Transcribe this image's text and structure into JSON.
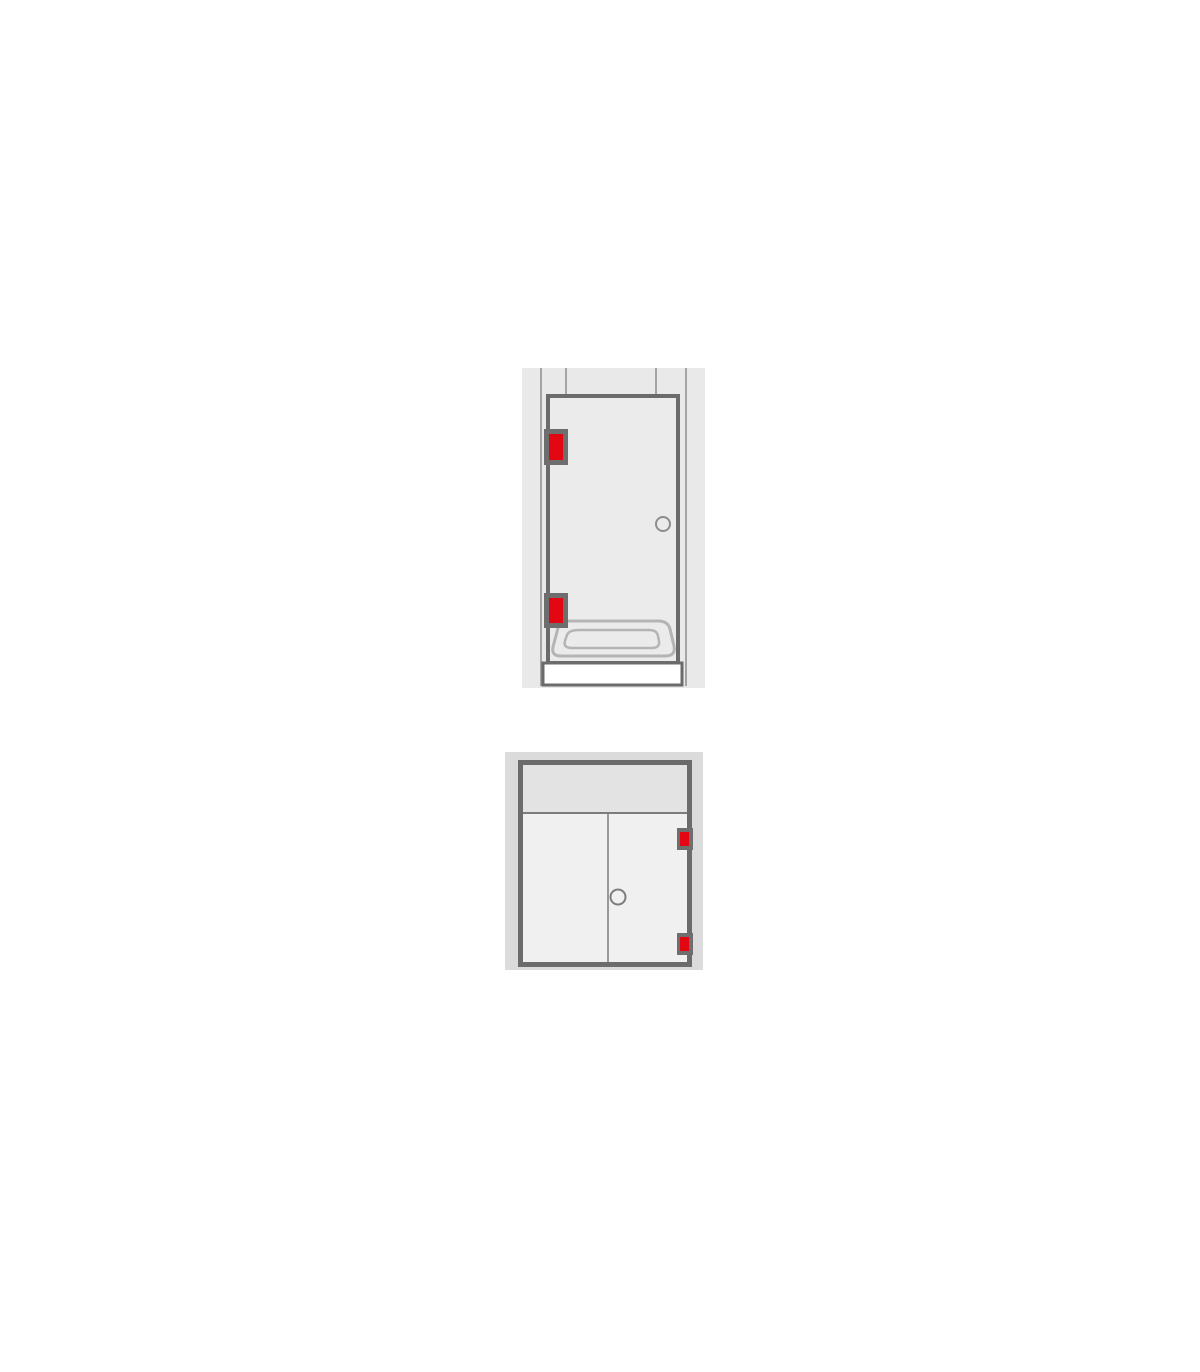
{
  "page": {
    "background": "#ffffff"
  },
  "colors": {
    "page_bg": "#ffffff",
    "wall_upper": "#e9e9e9",
    "wall_lower": "#dbdbdb",
    "glass": "#ebebeb",
    "door_panel": "#f0f0f0",
    "transom_panel": "#e3e3e3",
    "frame": "#6b6b6b",
    "frame_thin": "#7c7c7c",
    "wall_line": "#8d8d8d",
    "hinge_mount": "#6e6e6e",
    "hinge_red": "#e30613",
    "tray_outline": "#b4b4b4",
    "tray_front": "#ffffff"
  },
  "diagrams": {
    "shower_door": {
      "name": "shower-door-in-niche-diagram",
      "hinge_count": 2,
      "hinge_side": "left",
      "handle": "round-knob",
      "icons": [
        "hinge-icon",
        "hinge-icon",
        "knob-handle-icon",
        "shower-tray-icon"
      ]
    },
    "glass_door": {
      "name": "glass-door-with-transom-diagram",
      "hinge_count": 2,
      "hinge_side": "right",
      "handle": "round-knob",
      "icons": [
        "hinge-icon",
        "hinge-icon",
        "knob-handle-icon"
      ]
    }
  }
}
